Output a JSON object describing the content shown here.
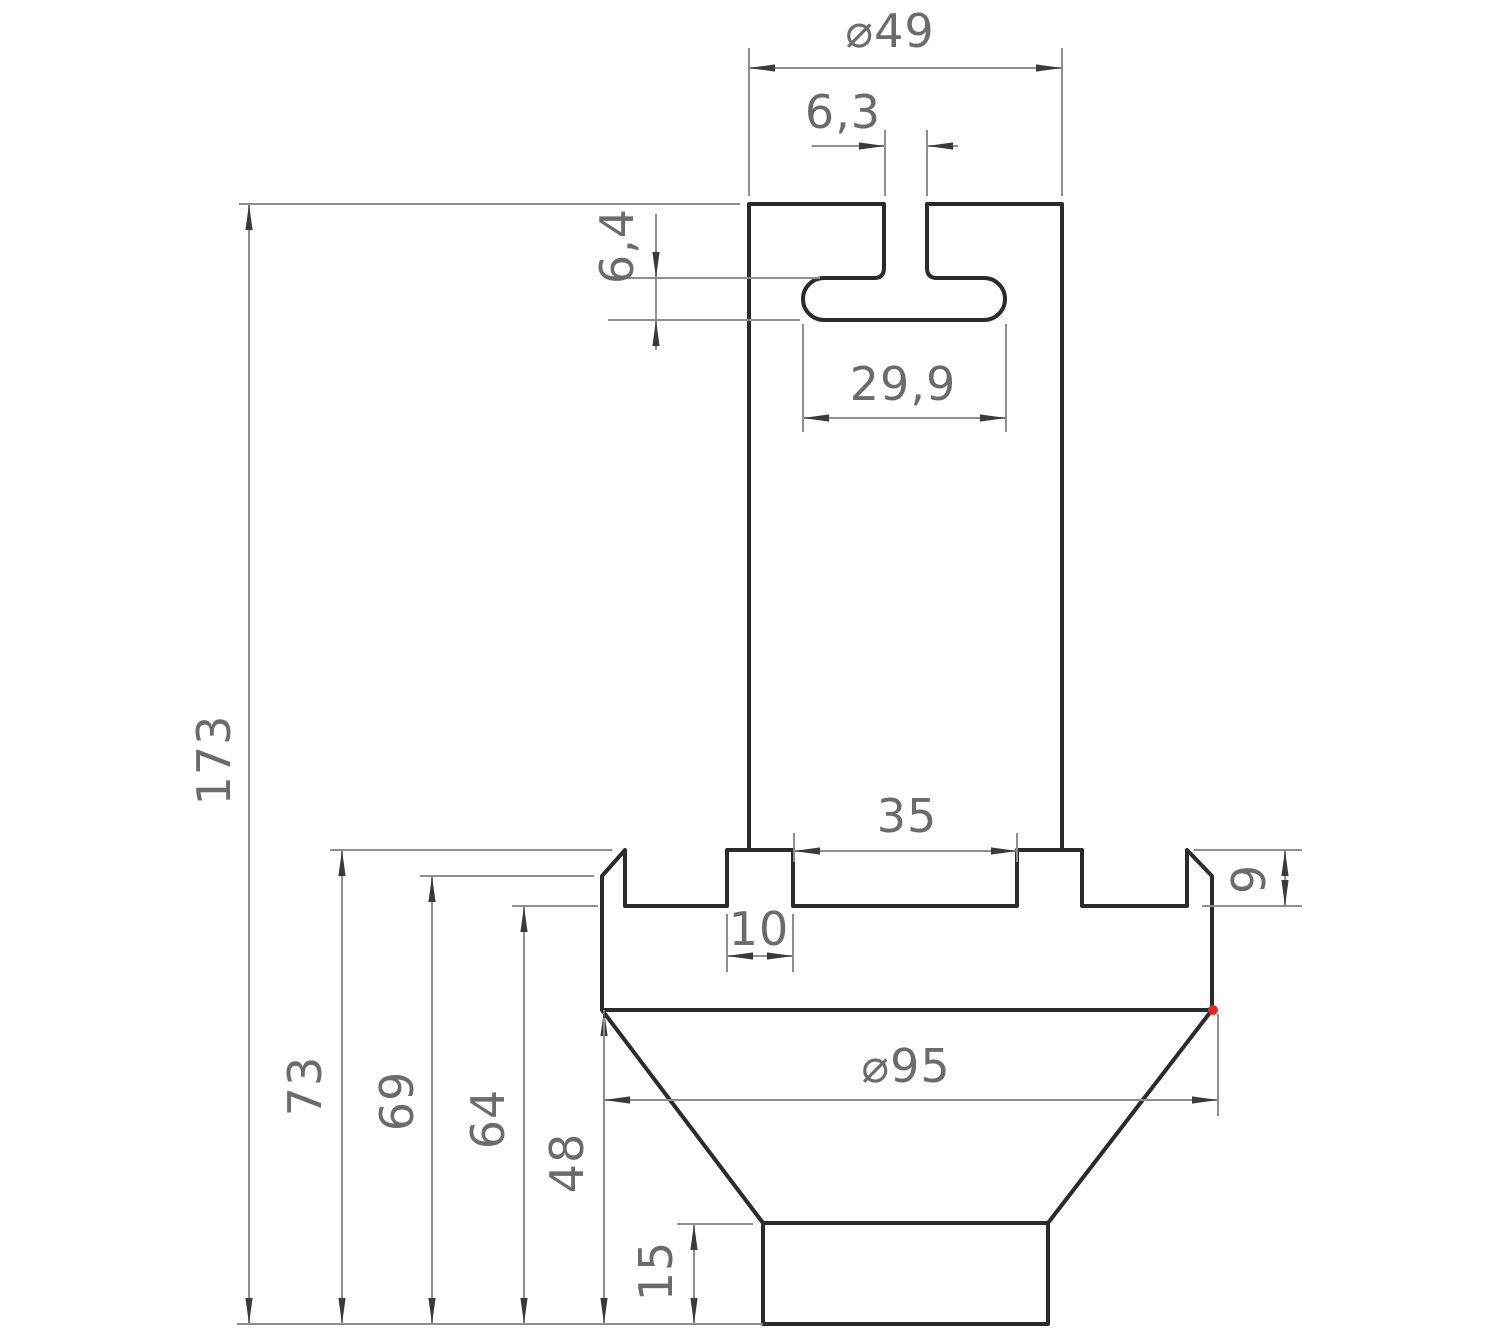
{
  "drawing": {
    "title": "T-slot adapter cross-section drawing",
    "units": "mm",
    "colors": {
      "background": "#ffffff",
      "outline": "#2b2b2b",
      "dimension_lines": "#8f8f8f",
      "arrowheads": "#3a3a3a",
      "dimension_text": "#6b6b6b",
      "highlight_dot": "#e8261f"
    },
    "dimensions": {
      "top_diameter": "⌀49",
      "top_slot_width": "6,3",
      "t_slot_height": "6,4",
      "t_slot_width": "29,9",
      "center_groove_width": "35",
      "key_tab_width": "10",
      "groove_depth": "9",
      "total_height": "173",
      "height_to_flange_top": "73",
      "height_to_chamfer": "69",
      "height_to_groove_floor": "64",
      "height_to_flange_bottom": "48",
      "base_block_height": "15",
      "flange_diameter": "⌀95"
    }
  }
}
